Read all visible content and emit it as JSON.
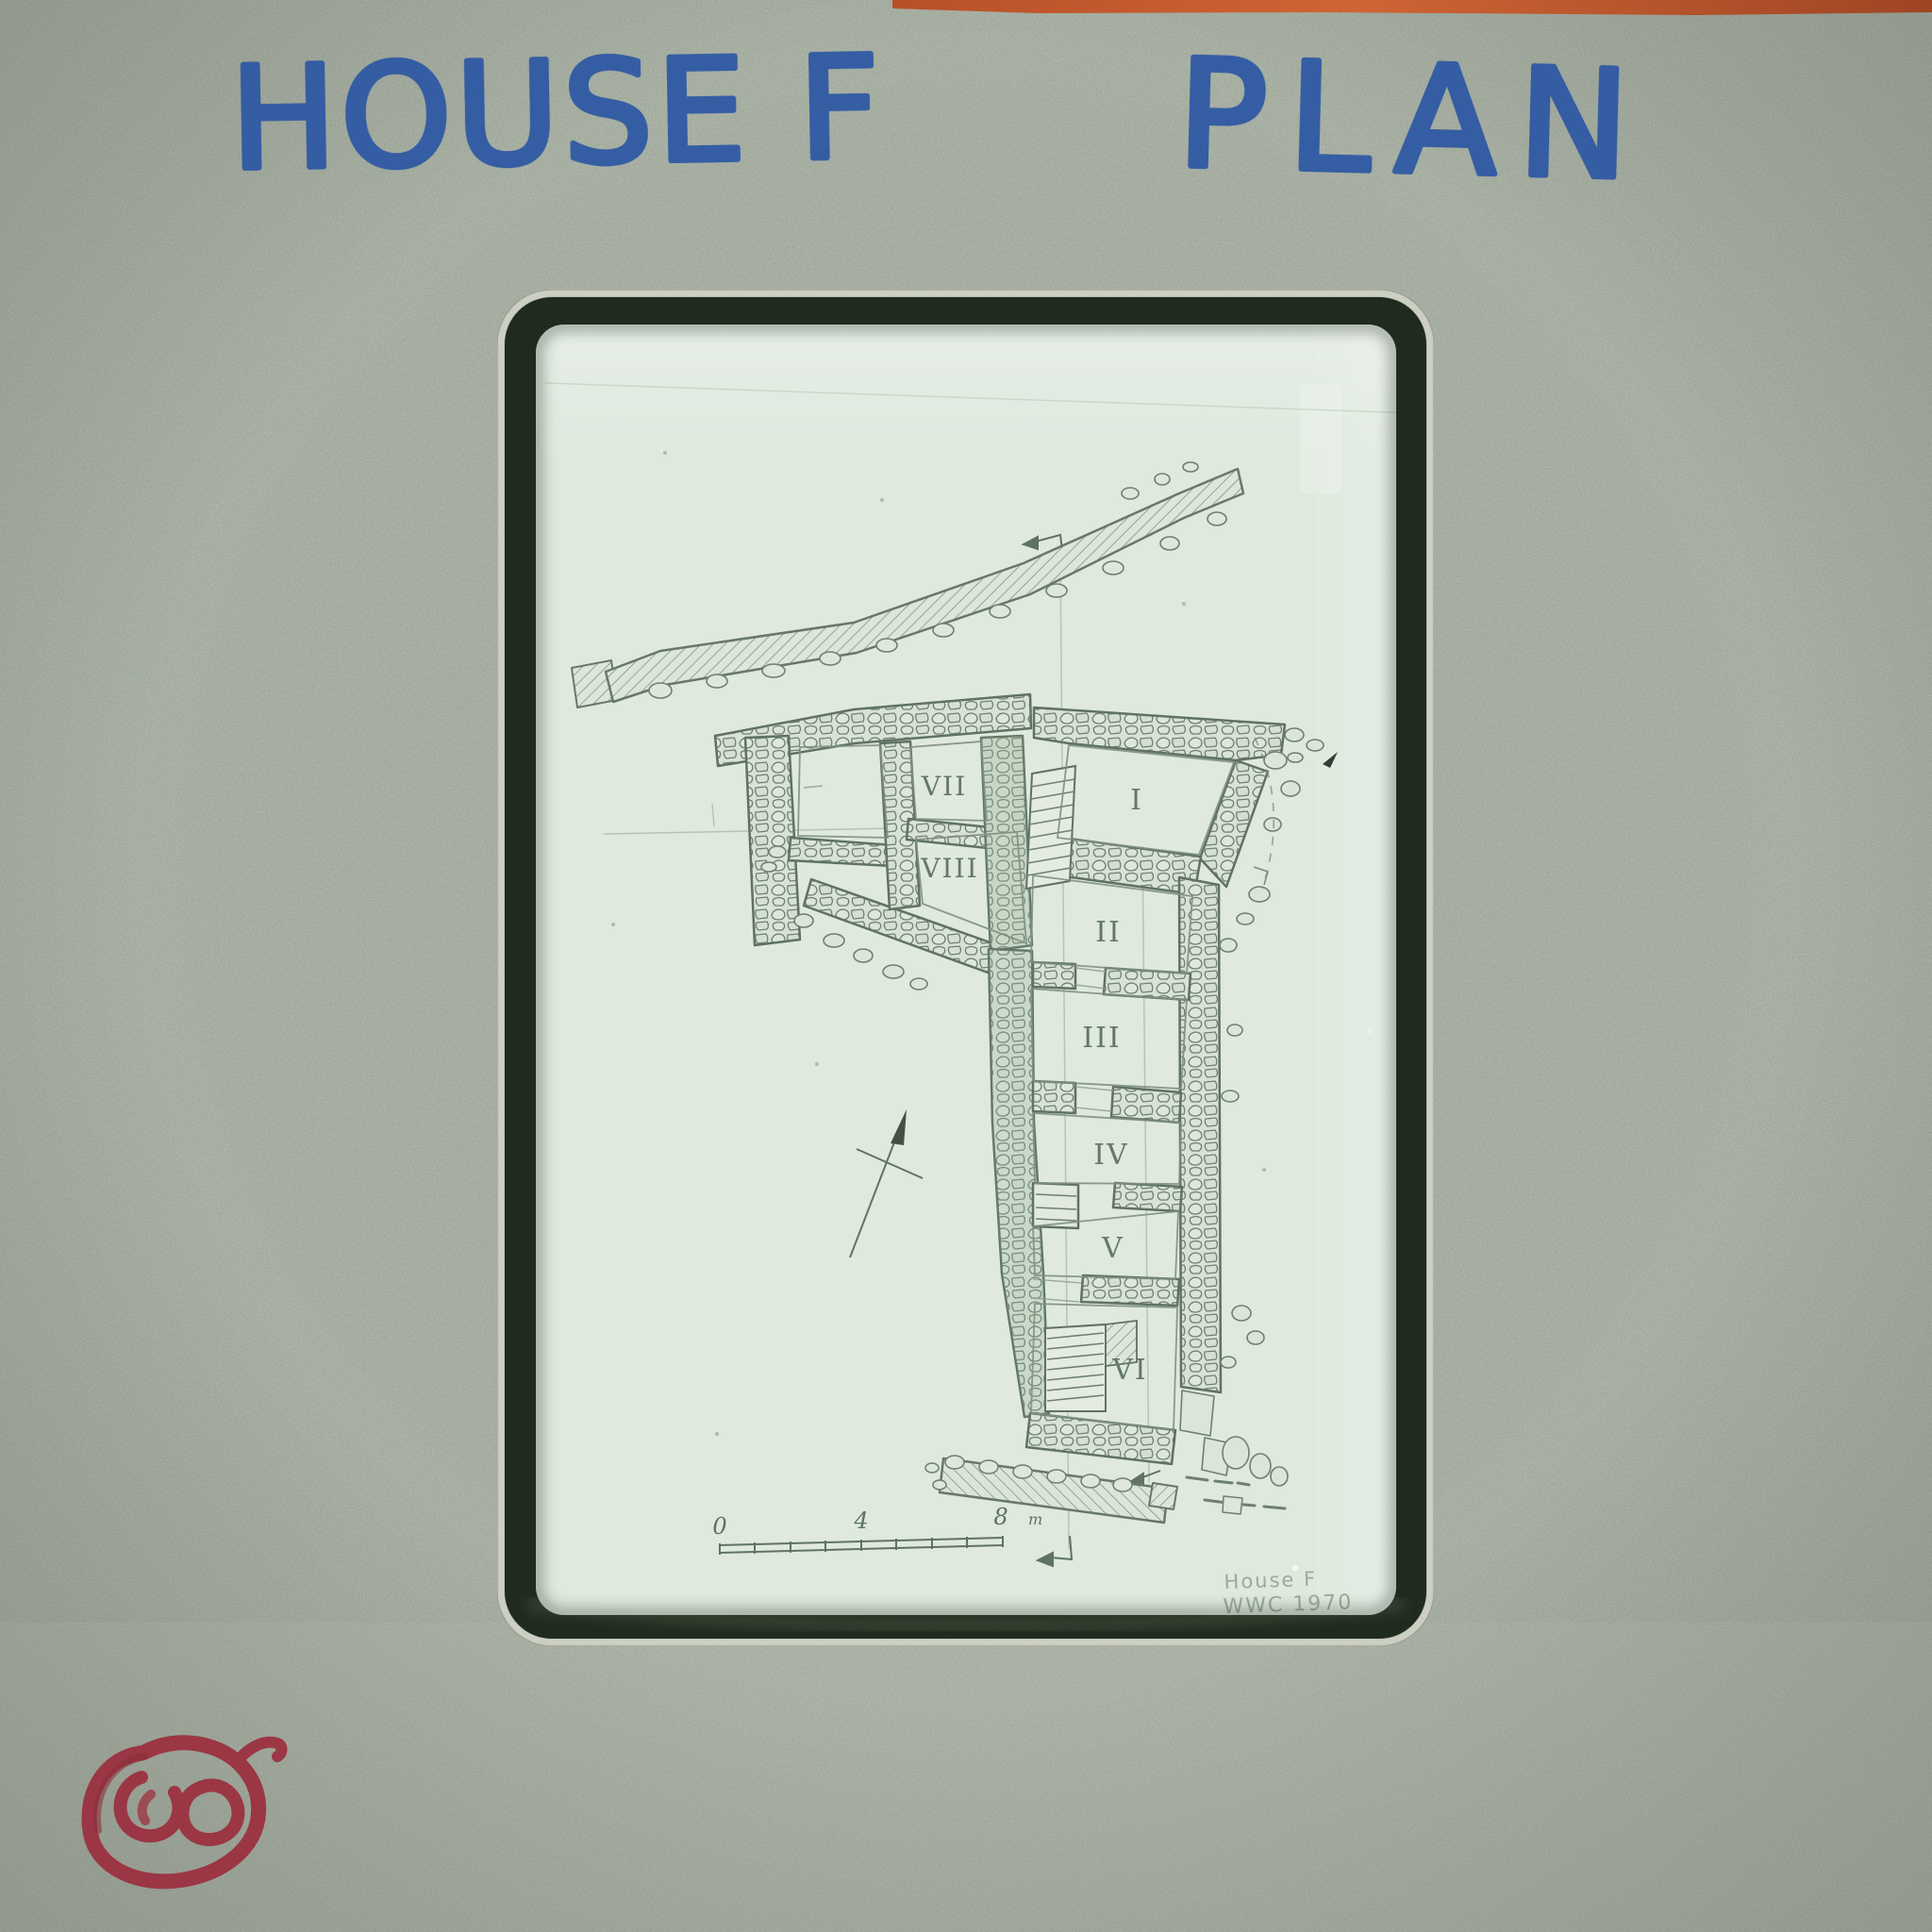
{
  "slide_label": {
    "title_left": "HOUSE F",
    "title_right": "PLAN"
  },
  "film": {
    "rooms": {
      "i": "I",
      "ii": "II",
      "iii": "III",
      "iv": "IV",
      "v": "V",
      "vi": "VI",
      "vii": "VII",
      "viii": "VIII"
    },
    "scale_bar": {
      "zero": "0",
      "four": "4",
      "eight": "8",
      "unit": "m"
    },
    "caption": {
      "line1": "House F",
      "line2": "WWC 1970"
    }
  },
  "colors": {
    "mount_grey": "#a0a99c",
    "film_green": "#dfe9de",
    "rim_dark": "#202b20",
    "drawing_ink": "#68796c",
    "marker_blue": "#2d58a4",
    "scribble_red": "#9c2e3e",
    "tape_orange": "#c05a31",
    "pencil_grey": "#90a093"
  }
}
